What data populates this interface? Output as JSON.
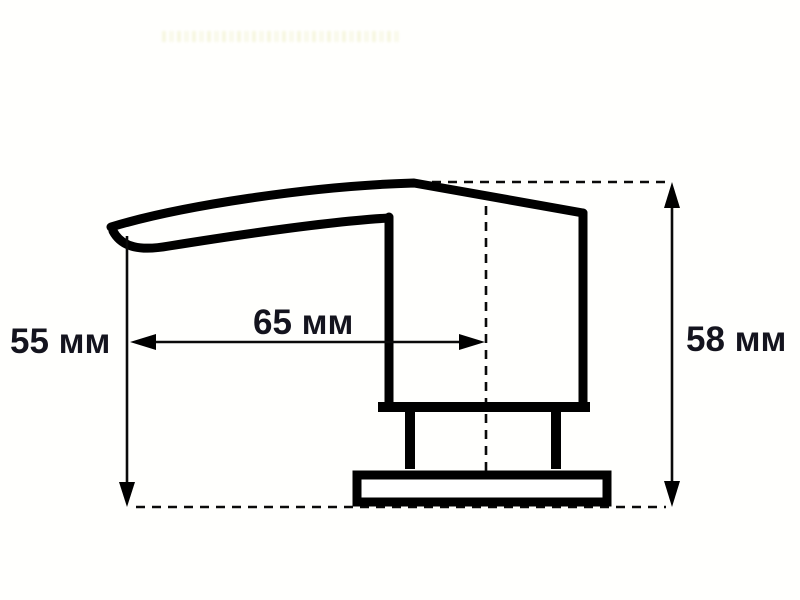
{
  "diagram": {
    "type": "technical-dimension-drawing",
    "subject": "soap-dispenser-pump-head-side-view",
    "unit": "мм",
    "background_color": "#fffffd",
    "line_color": "#000000",
    "text_color": "#14141e",
    "dimensions": [
      {
        "id": "spout-height",
        "label": "55 мм",
        "value": 55,
        "unit": "мм",
        "orientation": "vertical",
        "position": "left"
      },
      {
        "id": "spout-reach",
        "label": "65 мм",
        "value": 65,
        "unit": "мм",
        "orientation": "horizontal",
        "position": "middle"
      },
      {
        "id": "overall-height",
        "label": "58 мм",
        "value": 58,
        "unit": "мм",
        "orientation": "vertical",
        "position": "right"
      }
    ]
  }
}
